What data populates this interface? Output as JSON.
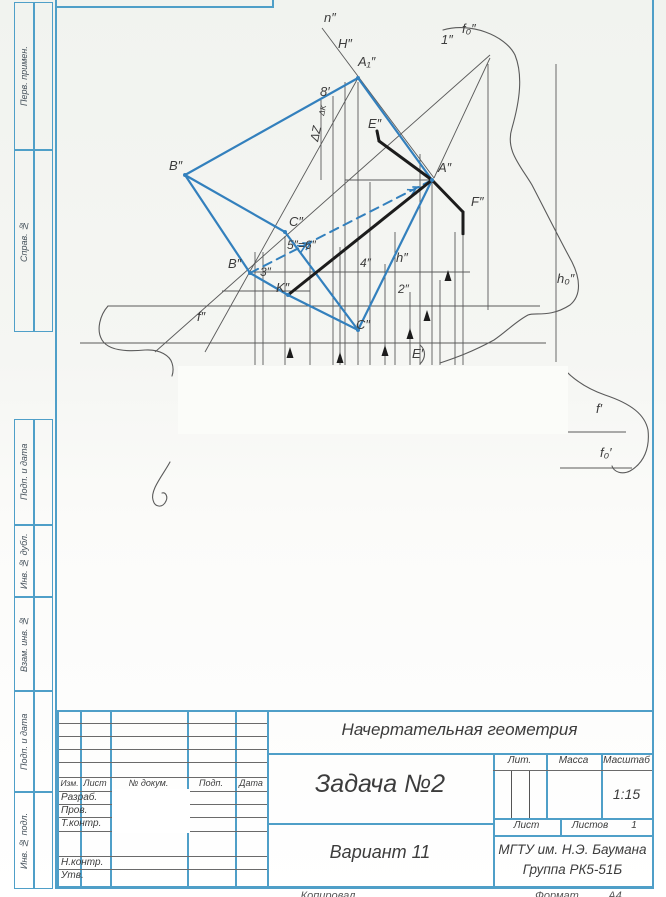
{
  "colors": {
    "frame_blue": "#4f9fc8",
    "figure_blue": "#3380bd",
    "thick_black": "#1c1c1c",
    "thin_gray": "#5a5a5a",
    "paper_white": "#fbfcf9"
  },
  "left_margin": {
    "boxes": [
      {
        "label": "Перв. примен.",
        "top": 2,
        "height": 148
      },
      {
        "label": "Справ. №",
        "top": 150,
        "height": 182
      },
      {
        "label": "Подп. и дата",
        "top": 419,
        "height": 106
      },
      {
        "label": "Инв. № дубл.",
        "top": 525,
        "height": 72
      },
      {
        "label": "Взам. инв. №",
        "top": 597,
        "height": 94
      },
      {
        "label": "Подп. и дата",
        "top": 691,
        "height": 101
      },
      {
        "label": "Инв. № подл.",
        "top": 792,
        "height": 97
      }
    ]
  },
  "title_block": {
    "course": "Начертательная геометрия",
    "task": "Задача №2",
    "variant": "Вариант 11",
    "org_line1": "МГТУ им. Н.Э. Баумана",
    "org_line2": "Группа РК5-51Б",
    "headers": {
      "izm": "Изм.",
      "list": "Лист",
      "doc": "№ докум.",
      "podp": "Подп.",
      "data": "Дата"
    },
    "rows": [
      "Разраб.",
      "Пров.",
      "Т.контр.",
      "Н.контр.",
      "Утв."
    ],
    "lit_label": "Лит.",
    "mass_label": "Масса",
    "scale_label": "Масштаб",
    "scale_value": "1:15",
    "sheet_label": "Лист",
    "sheets_label": "Листов",
    "sheets_value": "1"
  },
  "footer": {
    "copied": "Копировал",
    "format_label": "Формат",
    "format_value": "А4"
  },
  "figure": {
    "labels": [
      {
        "t": "n″",
        "x": 324,
        "y": 22
      },
      {
        "t": "H″",
        "x": 338,
        "y": 48
      },
      {
        "t": "A₁″",
        "x": 358,
        "y": 66
      },
      {
        "t": "1″",
        "x": 441,
        "y": 44
      },
      {
        "t": "f₀″",
        "x": 462,
        "y": 33
      },
      {
        "t": "8′",
        "x": 320,
        "y": 96
      },
      {
        "t": "E″",
        "x": 368,
        "y": 128
      },
      {
        "t": "B″",
        "x": 169,
        "y": 170
      },
      {
        "t": "A″",
        "x": 438,
        "y": 172
      },
      {
        "t": "F″",
        "x": 471,
        "y": 206
      },
      {
        "t": "C″",
        "x": 289,
        "y": 226
      },
      {
        "t": "5″=6″",
        "x": 287,
        "y": 249,
        "s": 12
      },
      {
        "t": "B″",
        "x": 228,
        "y": 268
      },
      {
        "t": "3″",
        "x": 260,
        "y": 276,
        "s": 12
      },
      {
        "t": "4″",
        "x": 360,
        "y": 267,
        "s": 12
      },
      {
        "t": "h″",
        "x": 396,
        "y": 262
      },
      {
        "t": "K″",
        "x": 276,
        "y": 292
      },
      {
        "t": "2″",
        "x": 398,
        "y": 293,
        "s": 12
      },
      {
        "t": "C″",
        "x": 356,
        "y": 329
      },
      {
        "t": "f″",
        "x": 197,
        "y": 321
      },
      {
        "t": "E′",
        "x": 412,
        "y": 358
      },
      {
        "t": "h₀″",
        "x": 557,
        "y": 283
      },
      {
        "t": "f′",
        "x": 596,
        "y": 413
      },
      {
        "t": "f₀′",
        "x": 600,
        "y": 457
      },
      {
        "t": "ΔZ",
        "x": 318,
        "y": 142,
        "r": -78,
        "s": 12
      },
      {
        "t": "ΔK",
        "x": 324,
        "y": 116,
        "r": -78,
        "s": 8
      }
    ],
    "blue_solid": [
      [
        185,
        175,
        358,
        78
      ],
      [
        358,
        78,
        432,
        180
      ],
      [
        185,
        175,
        285,
        232
      ],
      [
        185,
        175,
        250,
        273
      ],
      [
        285,
        232,
        358,
        330
      ],
      [
        250,
        273,
        288,
        295
      ],
      [
        288,
        295,
        358,
        330
      ],
      [
        358,
        330,
        432,
        180
      ]
    ],
    "blue_dashed": [
      [
        250,
        273,
        432,
        180
      ]
    ],
    "chevrons": [
      {
        "x": 305,
        "y": 246,
        "a": -27
      },
      {
        "x": 415,
        "y": 190,
        "a": -27
      }
    ],
    "thick": [
      [
        377,
        131,
        379,
        141
      ],
      [
        379,
        141,
        432,
        180
      ],
      [
        432,
        180,
        463,
        212
      ],
      [
        463,
        212,
        463,
        234
      ],
      [
        432,
        180,
        288,
        295
      ]
    ],
    "thin": [
      [
        333,
        96,
        333,
        365
      ],
      [
        345,
        82,
        345,
        365
      ],
      [
        358,
        82,
        358,
        365
      ],
      [
        370,
        182,
        370,
        365
      ],
      [
        255,
        252,
        255,
        365
      ],
      [
        263,
        252,
        263,
        365
      ],
      [
        285,
        236,
        285,
        365
      ],
      [
        310,
        245,
        310,
        365
      ],
      [
        340,
        247,
        340,
        365
      ],
      [
        385,
        264,
        385,
        365
      ],
      [
        395,
        232,
        395,
        365
      ],
      [
        410,
        292,
        410,
        365
      ],
      [
        420,
        154,
        420,
        365
      ],
      [
        432,
        182,
        432,
        365
      ],
      [
        440,
        280,
        440,
        365
      ],
      [
        455,
        232,
        455,
        365
      ],
      [
        463,
        236,
        463,
        365
      ],
      [
        488,
        64,
        488,
        310
      ],
      [
        556,
        64,
        556,
        362
      ],
      [
        321,
        100,
        321,
        180
      ],
      [
        108,
        306,
        540,
        306
      ],
      [
        80,
        343,
        546,
        343
      ],
      [
        345,
        180,
        430,
        180
      ],
      [
        222,
        291,
        310,
        291
      ],
      [
        250,
        272,
        470,
        272
      ],
      [
        565,
        432,
        626,
        432
      ],
      [
        560,
        468,
        632,
        468
      ],
      [
        155,
        352,
        490,
        55
      ],
      [
        322,
        28,
        434,
        178
      ],
      [
        490,
        58,
        434,
        178
      ],
      [
        205,
        352,
        358,
        78
      ]
    ],
    "arrows_up": [
      [
        290,
        347
      ],
      [
        340,
        352
      ],
      [
        385,
        345
      ],
      [
        410,
        328
      ],
      [
        427,
        310
      ],
      [
        448,
        270
      ]
    ],
    "curves": [
      "M443,30 C470,22 505,35 515,55 C523,75 520,100 512,128 C505,150 520,165 532,185 C545,210 560,240 572,262 C580,278 582,295 570,305 C550,318 535,312 528,315 C515,322 506,332 494,340 C472,352 455,358 440,363",
      "M563,368 C572,378 585,388 605,395 C632,404 645,415 648,430 C650,448 644,463 630,471 C622,475 614,472 612,466",
      "M108,306 C100,315 96,330 102,340 C108,350 125,352 145,350 C160,349 170,356 172,363 C174,369 173,373 172,376",
      "M170,462 C163,475 150,490 153,500 C155,508 163,508 166,501 C168,497 166,492 162,493",
      "M420,345 C426,350 426,358 420,364"
    ],
    "dots": [
      [
        358,
        78
      ],
      [
        185,
        175
      ],
      [
        432,
        180
      ],
      [
        285,
        232
      ],
      [
        250,
        273
      ],
      [
        288,
        295
      ],
      [
        358,
        330
      ]
    ],
    "whiteouts": [
      [
        178,
        366,
        390,
        68
      ]
    ]
  }
}
